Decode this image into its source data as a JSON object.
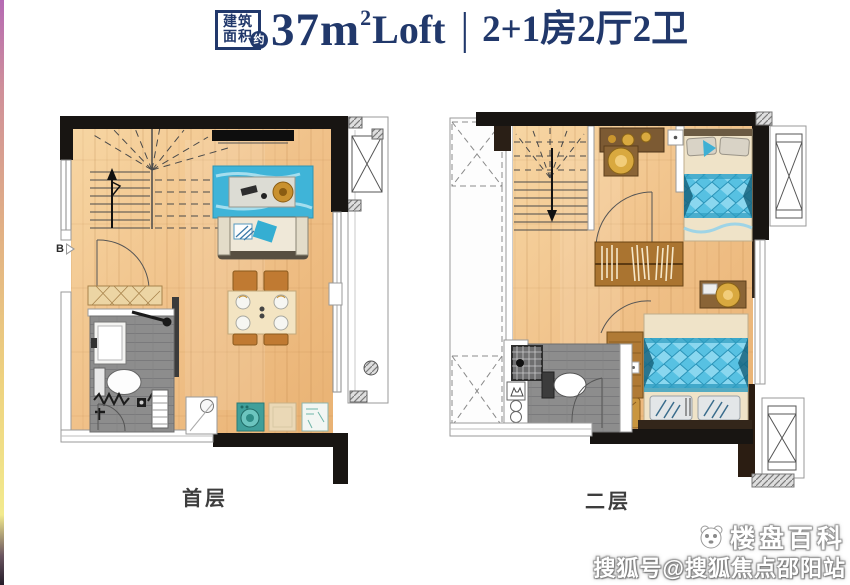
{
  "header": {
    "badge": {
      "line1": "建筑",
      "line2": "面积",
      "tag": "约"
    },
    "area": {
      "value": "37m",
      "sup": "2",
      "suffix": "Loft"
    },
    "divider": "|",
    "spec": "2+1房2厅2卫"
  },
  "plans": {
    "first": {
      "label": "首层",
      "entry_marker": "B"
    },
    "second": {
      "label": "二层"
    }
  },
  "watermark": {
    "brand": "楼盘百科",
    "handle": "搜狐号@搜狐焦点邵阳站"
  },
  "colors": {
    "navy": "#21386b",
    "wall_black": "#181512",
    "floor_wood": "#f0c189",
    "bath_tile": "#8d8d8d",
    "rug_teal": "#3fb4d8",
    "bed_blue": "#57c1e2",
    "furniture_wood": "#b07a35",
    "appliance_teal": "#409f9a",
    "lamp_gold": "#d9a93f"
  }
}
